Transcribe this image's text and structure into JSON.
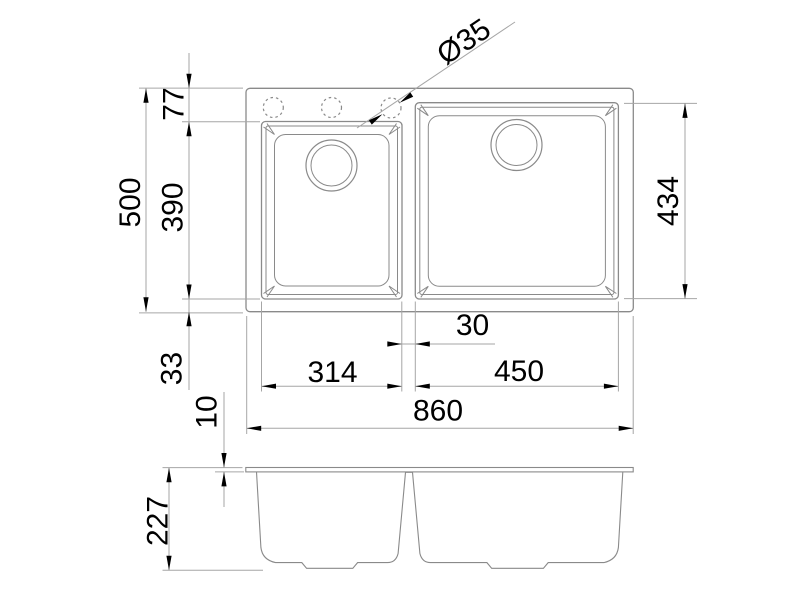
{
  "drawing": {
    "type": "sink-dimension-drawing",
    "colors": {
      "background": "#ffffff",
      "object_line": "#8a8a8a",
      "dimension_line": "#a6a6a6",
      "text": "#000000"
    }
  },
  "top_view": {
    "dims": {
      "overall_width": "860",
      "overall_depth": "500",
      "top_margin": "77",
      "small_bowl_depth": "390",
      "bottom_margin": "33",
      "small_bowl_width": "314",
      "large_bowl_width": "450",
      "bowl_gap": "30",
      "large_bowl_depth": "434",
      "faucet_hole_diameter": "Ø35"
    }
  },
  "section_view": {
    "dims": {
      "overall_height": "227",
      "rim_thickness": "10"
    }
  }
}
